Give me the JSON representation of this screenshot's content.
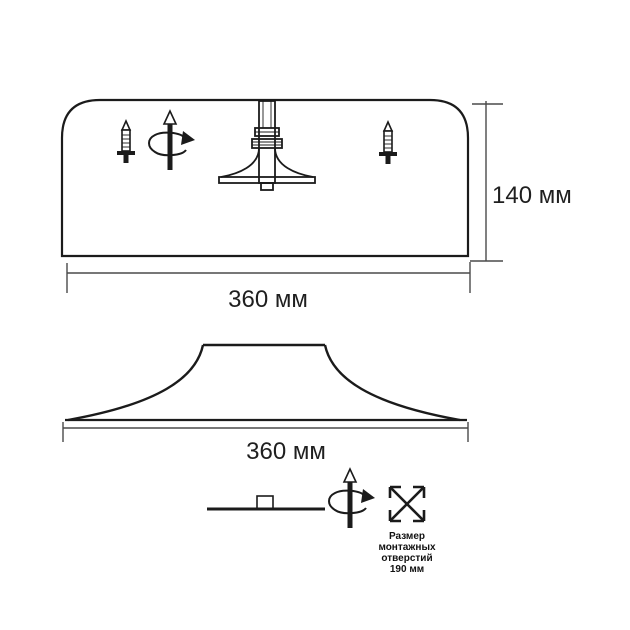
{
  "title": "Светильник — технический чертёж",
  "colors": {
    "ink": "#1b1b1b",
    "dimension_line": "#4a4a4a",
    "background": "#ffffff"
  },
  "front_view": {
    "height_dimension_label": "140 мм",
    "width_dimension_label": "360 мм"
  },
  "profile_view": {
    "width_dimension_label": "360 мм"
  },
  "legend": {
    "caption_line_1": "Размер",
    "caption_line_2": "монтажных",
    "caption_line_3": "отверстий",
    "caption_line_4": "190 мм"
  },
  "icons": {
    "screw": "screw-icon",
    "rotation": "rotation-axis-icon",
    "mount": "mount-bracket-icon",
    "mounting_holes": "mounting-holes-icon"
  }
}
